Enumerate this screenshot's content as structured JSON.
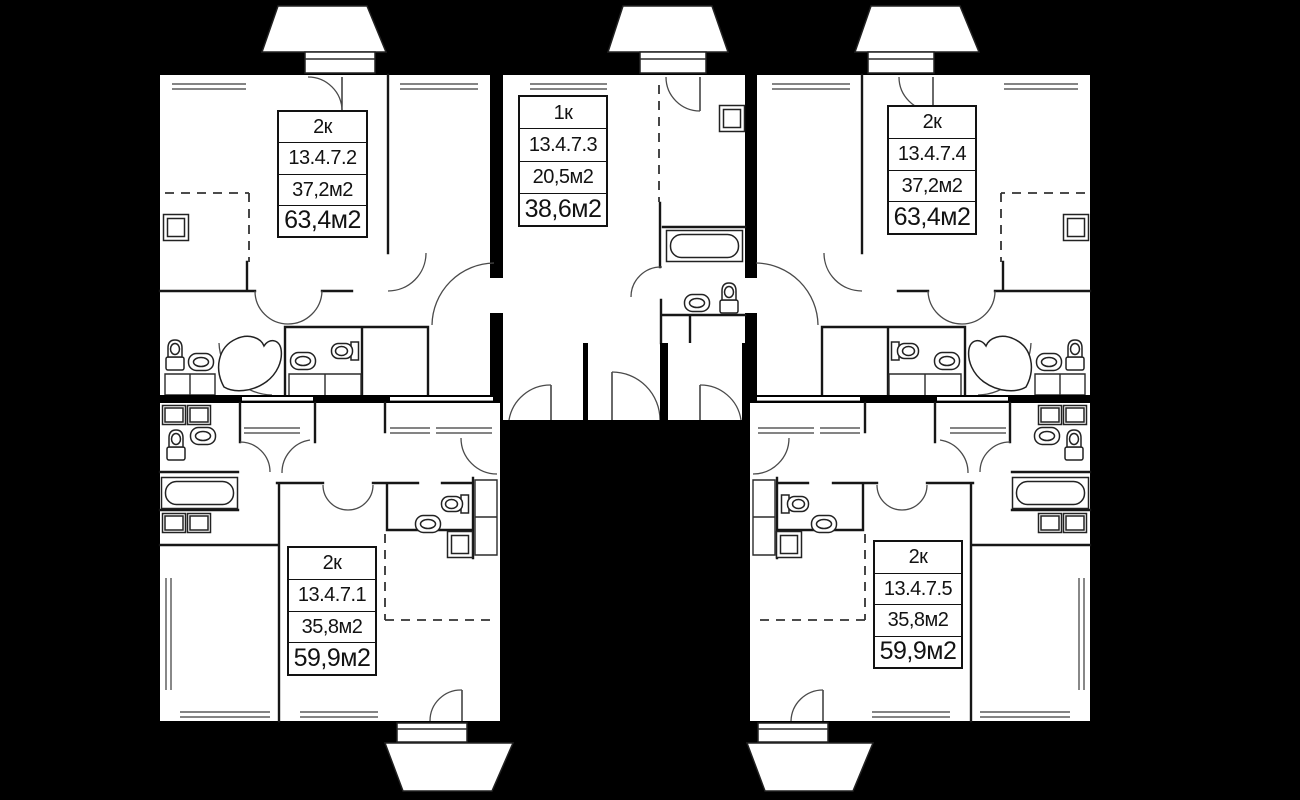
{
  "plan": {
    "description": "Apartment floor plan, five units on black background",
    "colors": {
      "background": "#000000",
      "floor": "#ffffff",
      "line": "#161616"
    }
  },
  "units": [
    {
      "number": "13.4.7.1",
      "type": "2к",
      "living_area": "35,8м2",
      "total_area": "59,9м2",
      "position": "bottom-left"
    },
    {
      "number": "13.4.7.2",
      "type": "2к",
      "living_area": "37,2м2",
      "total_area": "63,4м2",
      "position": "top-left"
    },
    {
      "number": "13.4.7.3",
      "type": "1к",
      "living_area": "20,5м2",
      "total_area": "38,6м2",
      "position": "top-middle"
    },
    {
      "number": "13.4.7.4",
      "type": "2к",
      "living_area": "37,2м2",
      "total_area": "63,4м2",
      "position": "top-right"
    },
    {
      "number": "13.4.7.5",
      "type": "2к",
      "living_area": "35,8м2",
      "total_area": "59,9м2",
      "position": "bottom-right"
    }
  ]
}
